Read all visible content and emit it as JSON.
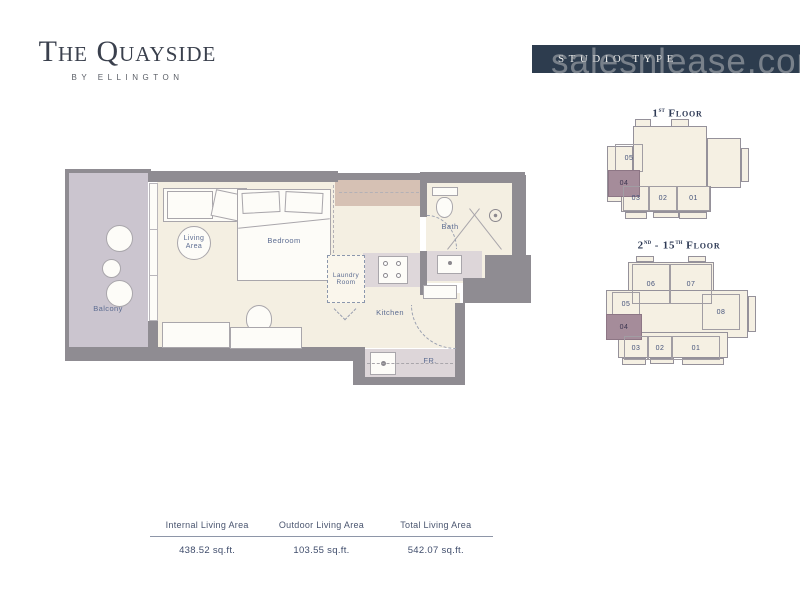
{
  "logo": {
    "title": "The Quayside",
    "subtitle": "BY ELLINGTON"
  },
  "banner": {
    "label": "STUDIO TYPE"
  },
  "watermark": "salesnlease.com",
  "plan": {
    "labels": {
      "balcony": "Balcony",
      "living_area": "Living Area",
      "bedroom": "Bedroom",
      "laundry_room": "Laundry Room",
      "kitchen": "Kitchen",
      "bath": "Bath",
      "fridge": "FR."
    }
  },
  "keyplans": [
    {
      "title": {
        "num": "1",
        "sup": "st",
        "rest": " Floor"
      },
      "units": [
        "05",
        "04",
        "03",
        "02",
        "01"
      ],
      "highlighted_unit": "04"
    },
    {
      "title": {
        "num": "2",
        "sup": "nd",
        "mid": " - 15",
        "sup2": "th",
        "rest": " Floor"
      },
      "units": [
        "06",
        "07",
        "05",
        "04",
        "08",
        "03",
        "02",
        "01"
      ],
      "highlighted_unit": "04"
    }
  ],
  "area_table": {
    "columns": [
      {
        "header": "Internal Living Area",
        "value": "438.52 sq.ft."
      },
      {
        "header": "Outdoor Living Area",
        "value": "103.55 sq.ft."
      },
      {
        "header": "Total Living Area",
        "value": "542.07 sq.ft."
      }
    ]
  },
  "colors": {
    "banner_navy": "#2d3c4e",
    "wall_gray": "#8f8c92",
    "floor_cream": "#f4efe2",
    "balcony_mauve": "#cbc5cf",
    "counter_mauve": "#ddd6d9",
    "wardrobe_tan": "#d6c1b4",
    "unit_highlight": "#a58c9a",
    "label_blue": "#5d6d92"
  }
}
